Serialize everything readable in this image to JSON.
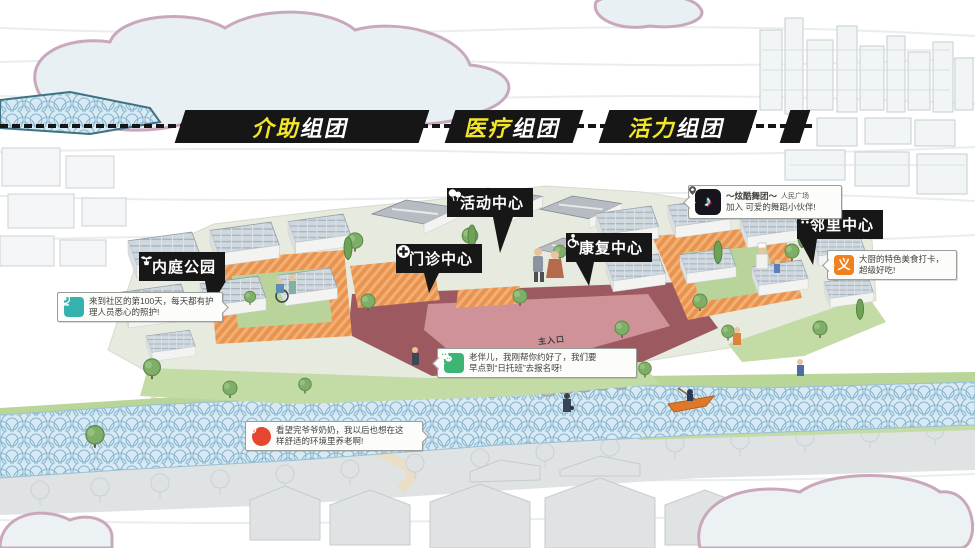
{
  "banners": [
    {
      "hl": "介助",
      "rest": "组团"
    },
    {
      "hl": "医疗",
      "rest": "组团"
    },
    {
      "hl": "活力",
      "rest": "组团"
    }
  ],
  "tags": {
    "park": {
      "label": "内庭公园"
    },
    "clinic": {
      "label": "门诊中心"
    },
    "activity": {
      "label": "活动中心"
    },
    "rehab": {
      "label": "康复中心"
    },
    "neighborhood": {
      "label": "邻里中心"
    }
  },
  "bubbles": {
    "care": {
      "line1": "来到社区的第100天，每天都有护",
      "line2": "理人员悉心的照护!"
    },
    "dance": {
      "title": "～炫酷舞团～",
      "pin": "人民广场",
      "line2": "加入 可爱的舞蹈小伙伴!"
    },
    "wechat": {
      "line1": "老伴儿，我刚帮你约好了，我们要",
      "line2": "早点到“日托班”去报名呀!"
    },
    "food": {
      "line1": "大厨的特色美食打卡，",
      "line2": "超级好吃!"
    },
    "weibo": {
      "line1": "看望完爷爷奶奶，我以后也想在这",
      "line2": "样舒适的环境里养老啊!"
    }
  },
  "site": {
    "entrance": "主入口"
  },
  "colors": {
    "banner_bg": "#161616",
    "banner_highlight": "#f2e52a",
    "tag_bg": "#171717",
    "wechat_green": "#3eb575",
    "weibo_red": "#e6452f",
    "dianping_orange": "#f0811e",
    "tiktok_black": "#16151d",
    "app_teal": "#35b2ad",
    "deck_orange": "#e8944e",
    "plaza_pink": "#cf9298",
    "river_blue": "#86b4d0",
    "cloud_outline": "#c9a8bc"
  }
}
